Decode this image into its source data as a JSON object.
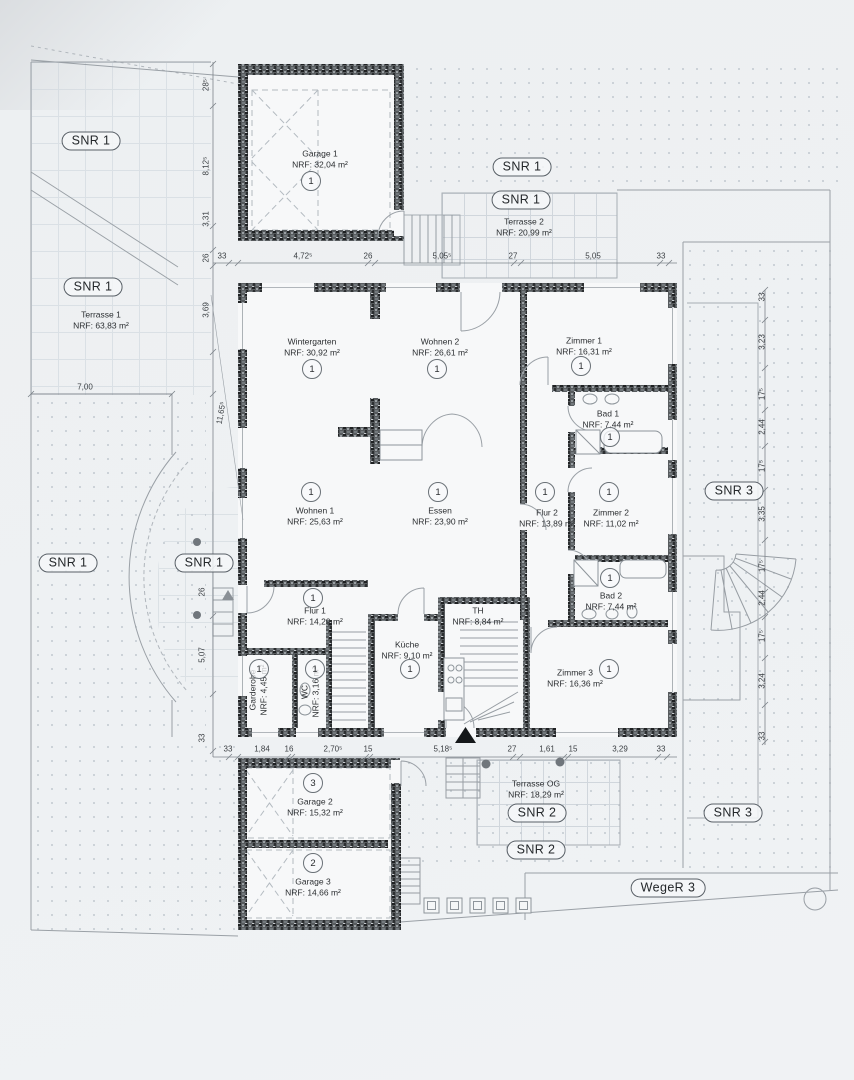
{
  "zones": {
    "snr1": "SNR 1",
    "snr2": "SNR 2",
    "snr3": "SNR 3",
    "weger3": "WegeR 3"
  },
  "rooms": [
    {
      "name": "Garage 1",
      "area": "NRF: 32,04 m²",
      "unit": "1"
    },
    {
      "name": "Wintergarten",
      "area": "NRF: 30,92 m²",
      "unit": "1"
    },
    {
      "name": "Wohnen 2",
      "area": "NRF: 26,61 m²",
      "unit": "1"
    },
    {
      "name": "Zimmer 1",
      "area": "NRF: 16,31 m²",
      "unit": "1"
    },
    {
      "name": "Bad 1",
      "area": "NRF: 7,44 m²",
      "unit": "1"
    },
    {
      "name": "Wohnen 1",
      "area": "NRF: 25,63 m²",
      "unit": "1"
    },
    {
      "name": "Essen",
      "area": "NRF: 23,90 m²",
      "unit": "1"
    },
    {
      "name": "Flur 2",
      "area": "NRF: 13,89 m²",
      "unit": "1"
    },
    {
      "name": "Zimmer 2",
      "area": "NRF: 11,02 m²",
      "unit": "1"
    },
    {
      "name": "Bad 2",
      "area": "NRF: 7,44 m²",
      "unit": "1"
    },
    {
      "name": "Flur 1",
      "area": "NRF: 14,29 m²",
      "unit": "1"
    },
    {
      "name": "Küche",
      "area": "NRF: 9,10 m²",
      "unit": "1"
    },
    {
      "name": "TH",
      "area": "NRF: 8,84 m²"
    },
    {
      "name": "Zimmer 3",
      "area": "NRF: 16,36 m²",
      "unit": "1"
    },
    {
      "name": "Garderobe",
      "area": "NRF: 4,45 m²",
      "unit": "1"
    },
    {
      "name": "WC",
      "area": "NRF: 3,16 m²",
      "unit": "1"
    },
    {
      "name": "Garage 2",
      "area": "NRF: 15,32 m²",
      "unit": "3"
    },
    {
      "name": "Garage 3",
      "area": "NRF: 14,66 m²",
      "unit": "2"
    },
    {
      "name": "Terrasse 1",
      "area": "NRF: 63,83 m²"
    },
    {
      "name": "Terrasse 2",
      "area": "NRF: 20,99 m²"
    },
    {
      "name": "Terrasse OG",
      "area": "NRF: 18,29 m²"
    }
  ],
  "dims": {
    "top": [
      "33",
      "4,72⁵",
      "26",
      "5,05⁵",
      "27",
      "5,05",
      "33"
    ],
    "bottom": [
      "33",
      "1,84",
      "16",
      "2,70⁵",
      "15",
      "5,18⁵",
      "27",
      "1,61",
      "15",
      "3,29",
      "33"
    ],
    "left_upper": [
      "28⁵",
      "8,12⁵",
      "3,31",
      "26",
      "3,69"
    ],
    "left_lower": [
      "26",
      "5,07",
      "33"
    ],
    "left_horizontal": "7,00",
    "left_diagonal": "11,65⁵",
    "right": [
      "33",
      "3,23",
      "17⁵",
      "2,44",
      "17⁵",
      "3,35",
      "17⁵",
      "2,44",
      "17⁵",
      "3,24",
      "33"
    ]
  }
}
